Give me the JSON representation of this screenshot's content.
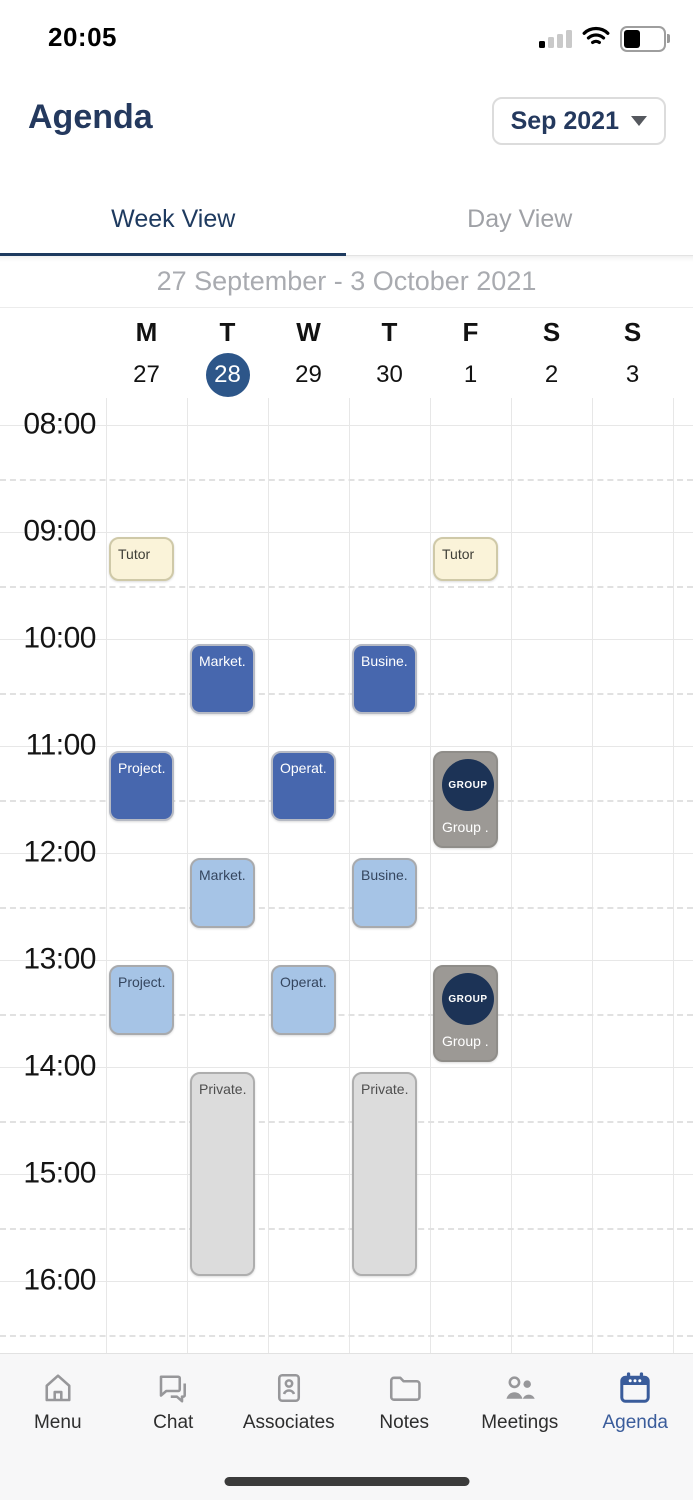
{
  "status_bar": {
    "time": "20:05",
    "icons": [
      "signal-icon",
      "wifi-icon",
      "battery-icon"
    ],
    "signal_bars_filled": 1,
    "signal_bars_total": 4
  },
  "header": {
    "title": "Agenda",
    "month_selector": {
      "label": "Sep 2021",
      "icon": "chevron-down-icon"
    }
  },
  "tabs": [
    {
      "label": "Week View",
      "active": true
    },
    {
      "label": "Day View",
      "active": false
    }
  ],
  "week_range": "27 September - 3 October 2021",
  "calendar": {
    "days": [
      {
        "letter": "M",
        "date": "27",
        "selected": false
      },
      {
        "letter": "T",
        "date": "28",
        "selected": true
      },
      {
        "letter": "W",
        "date": "29",
        "selected": false
      },
      {
        "letter": "T",
        "date": "30",
        "selected": false
      },
      {
        "letter": "F",
        "date": "1",
        "selected": false
      },
      {
        "letter": "S",
        "date": "2",
        "selected": false
      },
      {
        "letter": "S",
        "date": "3",
        "selected": false
      }
    ],
    "hours": [
      "08:00",
      "09:00",
      "10:00",
      "11:00",
      "12:00",
      "13:00",
      "14:00",
      "15:00",
      "16:00"
    ],
    "events": [
      {
        "day": 0,
        "label": "Tutor",
        "start": "09:00",
        "end": "09:30",
        "style": "yellow"
      },
      {
        "day": 4,
        "label": "Tutor",
        "start": "09:00",
        "end": "09:30",
        "style": "yellow"
      },
      {
        "day": 1,
        "label": "Market...",
        "start": "10:00",
        "end": "10:45",
        "style": "blue"
      },
      {
        "day": 3,
        "label": "Busine...",
        "start": "10:00",
        "end": "10:45",
        "style": "blue"
      },
      {
        "day": 0,
        "label": "Project...",
        "start": "11:00",
        "end": "11:45",
        "style": "blue"
      },
      {
        "day": 2,
        "label": "Operat...",
        "start": "11:00",
        "end": "11:45",
        "style": "blue"
      },
      {
        "day": 4,
        "label": "Group ...",
        "badge": "GROUP",
        "start": "11:00",
        "end": "12:00",
        "style": "group"
      },
      {
        "day": 1,
        "label": "Market...",
        "start": "12:00",
        "end": "12:45",
        "style": "lightblue"
      },
      {
        "day": 3,
        "label": "Busine...",
        "start": "12:00",
        "end": "12:45",
        "style": "lightblue"
      },
      {
        "day": 0,
        "label": "Project...",
        "start": "13:00",
        "end": "13:45",
        "style": "lightblue"
      },
      {
        "day": 2,
        "label": "Operat...",
        "start": "13:00",
        "end": "13:45",
        "style": "lightblue"
      },
      {
        "day": 4,
        "label": "Group ...",
        "badge": "GROUP",
        "start": "13:00",
        "end": "14:00",
        "style": "group"
      },
      {
        "day": 1,
        "label": "Private...",
        "start": "14:00",
        "end": "16:00",
        "style": "gray"
      },
      {
        "day": 3,
        "label": "Private...",
        "start": "14:00",
        "end": "16:00",
        "style": "gray"
      }
    ]
  },
  "nav": {
    "items": [
      {
        "label": "Menu",
        "icon": "home-icon",
        "active": false
      },
      {
        "label": "Chat",
        "icon": "chat-icon",
        "active": false
      },
      {
        "label": "Associates",
        "icon": "contact-card-icon",
        "active": false
      },
      {
        "label": "Notes",
        "icon": "folder-icon",
        "active": false
      },
      {
        "label": "Meetings",
        "icon": "people-icon",
        "active": false
      },
      {
        "label": "Agenda",
        "icon": "calendar-icon",
        "active": true
      }
    ]
  },
  "colors": {
    "navy": "#24395E",
    "tab_active": "#1E3A5F",
    "selected_day": "#2D5689",
    "event_blue": "#4767AE",
    "event_lightblue": "#A6C4E6",
    "event_yellow": "#FAF3D9",
    "event_gray": "#DCDCDC",
    "group_card": "#9C9995",
    "group_badge": "#1C3356",
    "nav_active": "#3A5C9B",
    "nav_inactive": "#97979A"
  }
}
